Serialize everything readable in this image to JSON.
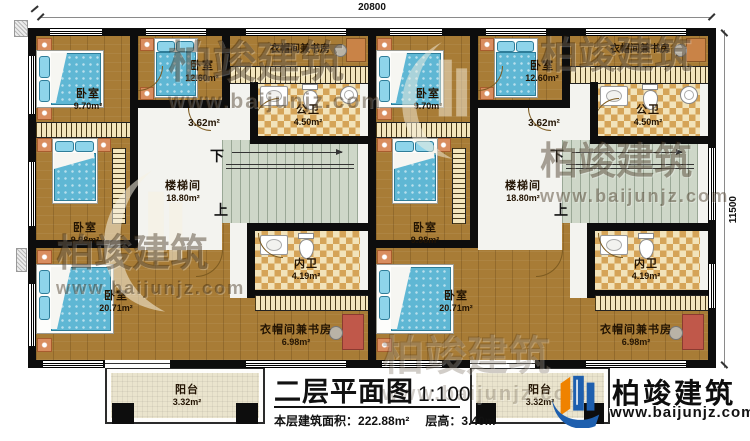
{
  "dimensions": {
    "top": "20800",
    "right": "11500"
  },
  "rooms": {
    "bed1": {
      "name": "卧室",
      "area": "9.70m²"
    },
    "bed3": {
      "name": "卧室",
      "area": "12.60m²"
    },
    "bed2": {
      "name": "卧室",
      "area": "9.98m²"
    },
    "bed4": {
      "name": "卧室",
      "area": "20.71m²"
    },
    "hall": {
      "area": "3.62m²"
    },
    "public_bath": {
      "name": "公卫",
      "area": "4.50m²"
    },
    "inner_bath": {
      "name": "内卫",
      "area": "4.19m²"
    },
    "stairwell": {
      "name": "楼梯间",
      "area": "18.80m²"
    },
    "cloak_study_top": {
      "name": "衣帽间兼书房"
    },
    "cloak_study_bottom": {
      "name": "衣帽间兼书房",
      "area": "6.98m²"
    },
    "stairs_down": "下",
    "stairs_up": "上"
  },
  "balcony": {
    "name": "阳台",
    "area": "3.32m²"
  },
  "title_block": {
    "title": "二层平面图",
    "scale": "1:100",
    "area_label": "本层建筑面积：",
    "area_value": "222.88m²",
    "floor_height_label": "层高：",
    "floor_height_value": "3.40m"
  },
  "brand": {
    "name": "柏竣建筑",
    "url": "www.baijunjz.com"
  },
  "colors": {
    "wood": "#a87c36",
    "wall": "#0d0d0d",
    "bed": "#5fb7d4",
    "tile": "#d5a458",
    "stairs": "#ced7c8",
    "balcony": "#eae4cd",
    "brand_blue": "#1e5fae",
    "brand_orange": "#ef8200"
  }
}
